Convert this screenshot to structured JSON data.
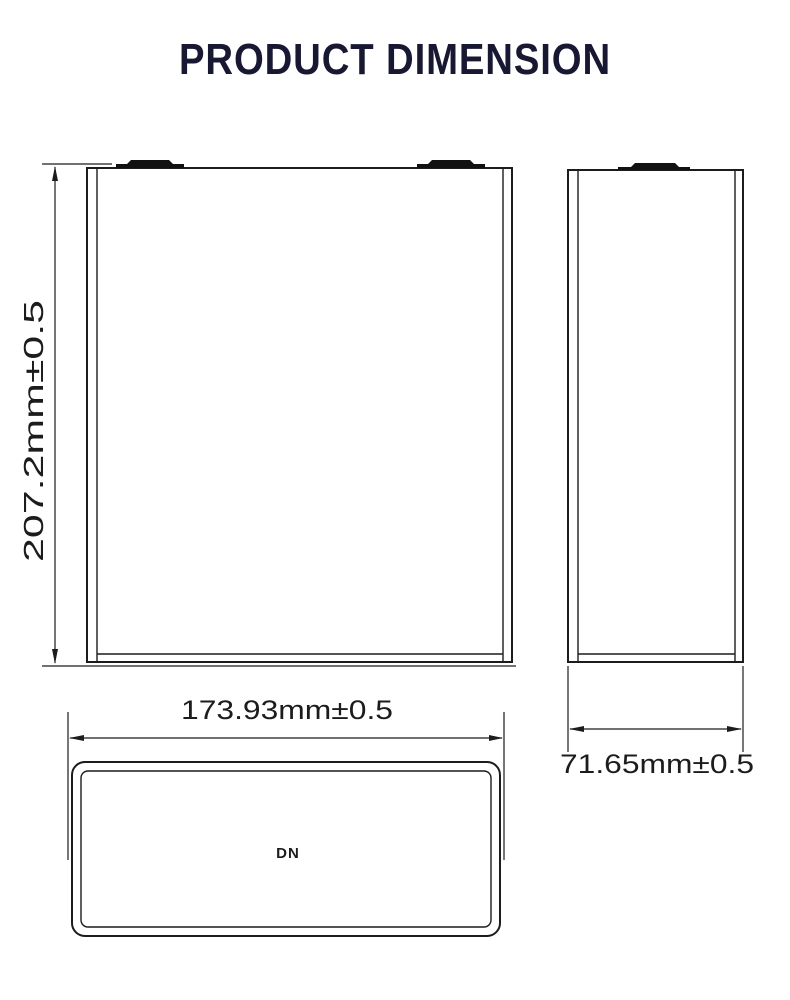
{
  "title": "PRODUCT DIMENSION",
  "front_view": {
    "height_dimension": "207.2mm±0.5"
  },
  "side_view": {
    "thickness_dimension": "71.65mm±0.5"
  },
  "top_view": {
    "width_dimension": "173.93mm±0.5",
    "marking": "DN"
  },
  "colors": {
    "line": "#1c1c1c",
    "title": "#181833",
    "background": "#ffffff",
    "terminal": "#111111"
  }
}
